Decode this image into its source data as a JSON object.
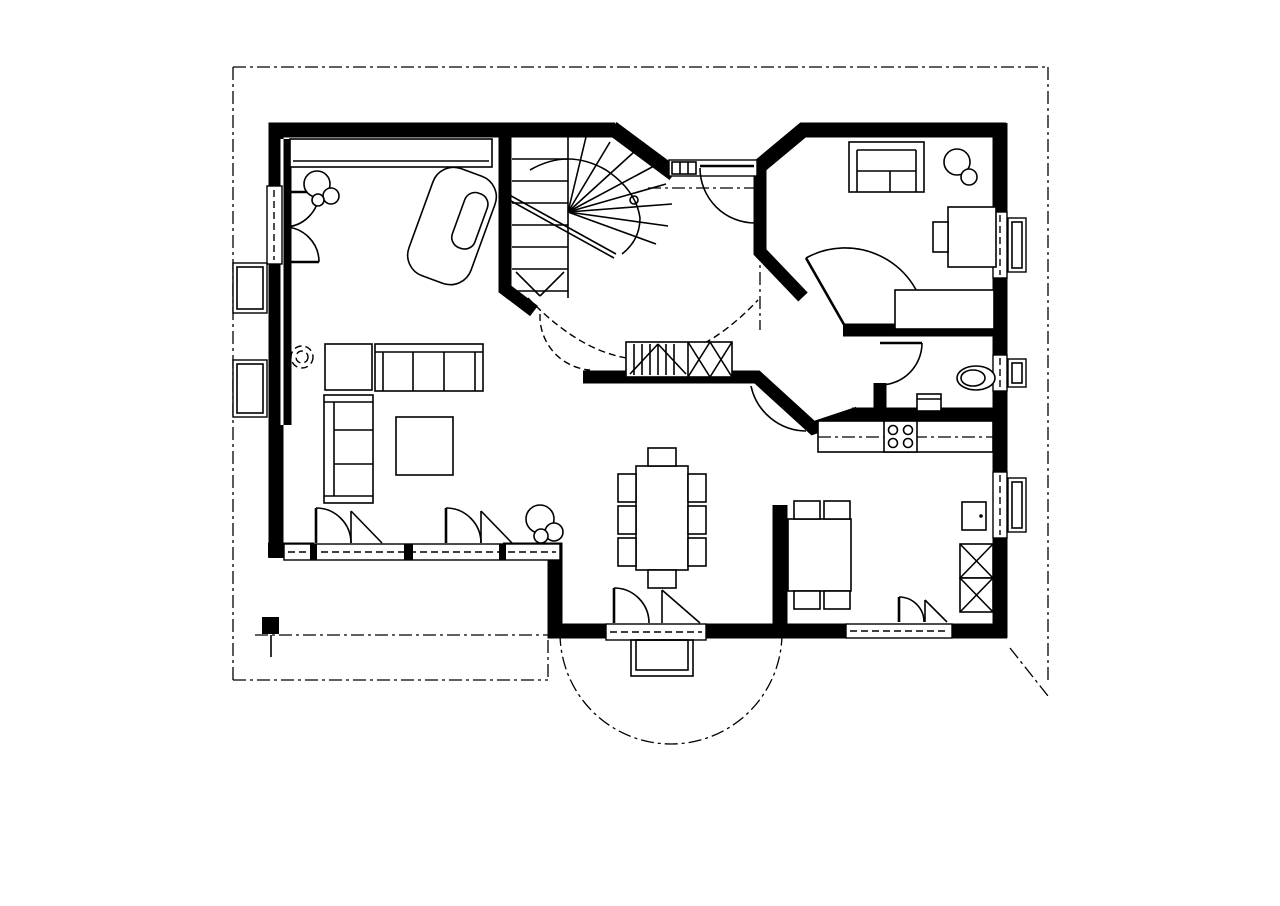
{
  "colors": {
    "ink": "#000000",
    "paper": "#ffffff"
  },
  "labels": {
    "bf": "BF:",
    "ff": "FF:"
  },
  "rooms": {
    "wohnen": {
      "name": "WOHNEN",
      "bf": "31.59 m²",
      "ff": "12.40 m²"
    },
    "entree": {
      "name": "ENTREE",
      "bf": "15.99 m²"
    },
    "buero": {
      "name": "BÜRO/GÄSTE",
      "bf": "11.29 m²",
      "ff": "1.36 m²"
    },
    "wc": {
      "name": "WC"
    },
    "essen": {
      "name": "ESSEN",
      "bf": "15.32 m²",
      "ff": "3.38 m²"
    },
    "kueche": {
      "name": "KÜCHE",
      "bf": "12.47 m²",
      "ff": "4.37 m²"
    }
  },
  "dimensions": {
    "height": "9.20",
    "width": "13.20",
    "level": "0.00"
  },
  "annotations": {
    "option_line1": "OPTION",
    "option_line2": "KAMIN",
    "fridge": "KS",
    "oven": "BO"
  },
  "title_block": {
    "title": "SMARAGD EXKLUSIV",
    "subtitle": "ERDGESCHOSS",
    "area": "NETTOGESCHOSSFLÄCHE 89.30M²"
  }
}
